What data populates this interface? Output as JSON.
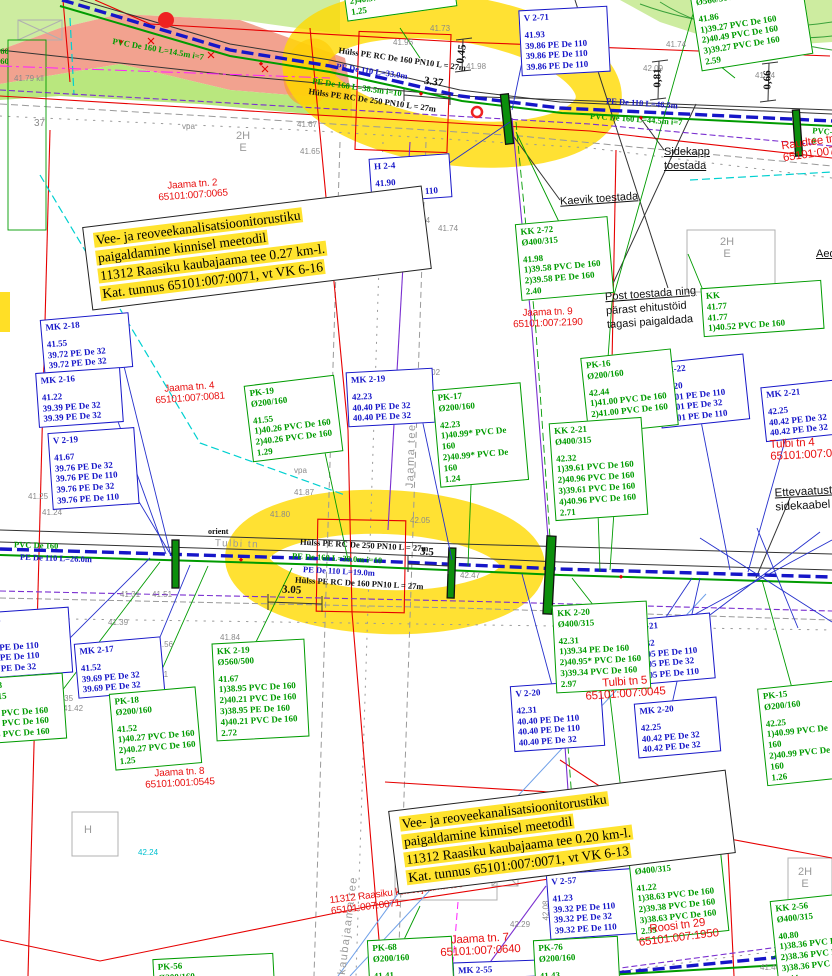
{
  "colors": {
    "water": "#1616c8",
    "sewer": "#009b00",
    "cadastral_red": "#e81111",
    "boundary_red": "#e60000",
    "highlight": "#ffd900",
    "cable_purple": "#7a2fd0",
    "magenta": "#ff00ff",
    "cyan": "#00d0d0",
    "survey_gray": "#8a8a8a"
  },
  "notes": {
    "note1": "Vee- ja reoveekanalisatsioonitorustiku\npaigaldamine kinnisel meetodil\n11312 Raasiku kaubajaama tee 0.27 km-l.\nKat. tunnus 65101:007:0071, vt VK 6-16",
    "note2": "Vee- ja reoveekanalisatsioonitorustiku\npaigaldamine kinnisel meetodil\n11312 Raasiku kaubajaama tee 0.20 km-l.\nKat. tunnus 65101:007:0071, vt VK 6-13"
  },
  "boxes": {
    "v2_71": {
      "t": "V 2-71",
      "b": "41.93\n39.86 PE De 110\n39.86 PE De 110\n39.86 PE De 110"
    },
    "h2_4": {
      "t": "H 2-4",
      "b": "41.90\n39.99 PE De 110"
    },
    "mk2_18": {
      "t": "MK 2-18",
      "b": "41.55\n39.72 PE De 32\n39.72 PE De 32"
    },
    "mk2_16": {
      "t": "MK 2-16",
      "b": "41.22\n39.39 PE De 32\n39.39 PE De 32"
    },
    "v2_19": {
      "t": "V 2-19",
      "b": "41.67\n39.76 PE De 32\n39.76 PE De 110\n39.76 PE De 32\n39.76 PE De 110"
    },
    "mk2_19": {
      "t": "MK 2-19",
      "b": "42.23\n40.40 PE De 32\n40.40 PE De 32"
    },
    "v2_22": {
      "t": "V 2-22",
      "b": "42.20\n40.01 PE De 110\n40.01 PE De 32\n40.01 PE De 110"
    },
    "mk2_21": {
      "t": "MK 2-21",
      "b": "42.25\n40.42 PE De 32\n40.42 PE De 32"
    },
    "v2_18": {
      "t": "V 2-18",
      "b": "41.08\n39.11 PE De 110\n39.11 PE De 110\n39.11 PE De 32"
    },
    "mk2_17": {
      "t": "MK 2-17",
      "b": "41.52\n39.69 PE De 32\n39.69 PE De 32"
    },
    "v2_21": {
      "t": "V 2-21",
      "b": "42.32\n40.05 PE De 110\n40.05 PE De 32\n40.05 PE De 110"
    },
    "v2_20": {
      "t": "V 2-20",
      "b": "42.31\n40.40 PE De 110\n40.40 PE De 110\n40.40 PE De 32"
    },
    "mk2_20": {
      "t": "MK 2-20",
      "b": "42.25\n40.42 PE De 32\n40.42 PE De 32"
    },
    "v2_57": {
      "t": "V 2-57",
      "b": "41.23\n39.32 PE De 110\n39.32 PE De 32\n39.32 PE De 110"
    },
    "mk2_55": {
      "t": "MK 2-55",
      "b": ""
    },
    "tl_part": {
      "t": "",
      "b": "2)40.37 PVC De 160\n1.25"
    },
    "o560": {
      "t": "Ø560/500",
      "b": "41.86\n1)39.27 PVC De 160\n2)40.49 PVC De 160\n3)39.27 PVC De 160\n2.59"
    },
    "kk2_72": {
      "t": "KK 2-72\nØ400/315",
      "b": "41.98\n1)39.58 PVC De 160\n2)39.58 PE De 160\n2.40"
    },
    "kk_part": {
      "t": "KK",
      "b": "41.77\n41.77\n1)40.52 PVC De 160"
    },
    "pk19": {
      "t": "PK-19\nØ200/160",
      "b": "41.55\n1)40.26 PVC De 160\n2)40.26 PVC De 160\n1.29"
    },
    "pk17": {
      "t": "PK-17\nØ200/160",
      "b": "42.23\n1)40.99* PVC De 160\n2)40.99* PVC De 160\n1.24"
    },
    "pk16": {
      "t": "PK-16\nØ200/160",
      "b": "42.44\n1)41.00 PVC De 160\n2)41.00 PVC De 160\n1.44"
    },
    "kk2_21": {
      "t": "KK 2-21\nØ400/315",
      "b": "42.32\n1)39.61 PVC De 160\n2)40.96 PVC De 160\n3)39.61 PVC De 160\n4)40.96 PVC De 160\n2.71"
    },
    "kk2_18": {
      "t": "KK 2-18\nØ400/315",
      "b": "1)38.76 PVC De 160\n2)38.71 PVC De 160\n3)38.76 PVC De 160"
    },
    "kk2_19": {
      "t": "KK 2-19\nØ560/500",
      "b": "41.67\n1)38.95 PVC De 160\n2)40.21 PVC De 160\n3)38.95 PE De 160\n4)40.21 PVC De 160\n2.72"
    },
    "pk18": {
      "t": "PK-18\nØ200/160",
      "b": "41.52\n1)40.27 PVC De 160\n2)40.27 PVC De 160\n1.25"
    },
    "kk2_20": {
      "t": "KK 2-20\nØ400/315",
      "b": "42.31\n1)39.34 PE De 160\n2)40.95* PVC De 160\n3)39.34 PVC De 160\n2.97"
    },
    "pk15": {
      "t": "PK-15\nØ200/160",
      "b": "42.25\n1)40.99 PVC De 160\n2)40.99 PVC De 160\n1.26"
    },
    "kk2_58": {
      "t": "KK 2-58\nØ400/315",
      "b": "41.22\n1)38.63 PVC De 160\n2)39.38 PVC De 160\n3)38.63 PVC De 160\n2.59"
    },
    "kk2_56": {
      "t": "KK 2-56\nØ400/315",
      "b": "40.80\n1)38.36 PVC De 160\n2)38.36 PVC De 160\n3)38.36 PVC De 160\n2.44"
    },
    "pk68": {
      "t": "PK-68\nØ200/160",
      "b": "41.41"
    },
    "pk76": {
      "t": "PK-76\nØ200/160",
      "b": "41.43"
    },
    "pk56": {
      "t": "PK-56\nØ200/160",
      "b": ""
    }
  },
  "cadastral": {
    "jaama2": "Jaama tn. 2\n65101:007:0065",
    "jaama4": "Jaama tn. 4\n65101:007:0081",
    "jaama9": "Jaama tn. 9\n65101:007:2190",
    "jaama8": "Jaama tn. 8\n65101:001:0545",
    "jaama7": "Jaama tn. 7\n65101:007:0640",
    "raudtee": "Raudtee tn\n65101:007:1",
    "tulbi4": "Tulbi tn 4\n65101:007:060",
    "tulbi5": "Tulbi tn 5\n65101:007:0045",
    "roosi29": "Roosi tn 29\n65101:007:1950",
    "kaubajaama": "11312 Raasiku kaubajaama tee\n65101:007:0071"
  },
  "annotations": {
    "kaevik": {
      "u": "Kaevik toestada",
      "rest": ""
    },
    "sidekapp": {
      "u": "Sidekapp\ntoestada",
      "rest": ""
    },
    "post": {
      "u": "Post toestada ning",
      "rest": "pärast ehitustöid\ntagasi paigaldada"
    },
    "ettevaatust": {
      "u": "Ettevaatust",
      "rest": "sidekaabel"
    },
    "aed": {
      "u": "Aed",
      "rest": ""
    }
  },
  "pipes": {
    "top_black": "Hülss PE RC De 160 PN10 L = 27m",
    "top_blue": "PE De 110 L=33.0m",
    "top_green": "PE De 160 L=38.5m i=10",
    "top_black2": "Hülss PE RC De 250 PN10 L = 27m",
    "tl_green": "PVC De 160 L=14.5m i=7",
    "tr_blue": "PE De 110 L=46.5m",
    "tr_green": "PVC De 160 L=44.5m i=7",
    "tr_green2": "PVC-6",
    "mid_black": "Hülss PE RC De 250 PN10 L = 27m",
    "mid_green": "PE De 160 L=39.0m i=10",
    "mid_blue": "PE De 110 L=19.0m",
    "mid_black2": "Hülss PE RC De 160 PN10 L = 27m",
    "ml_blue": "PE De 110 L=26.0m",
    "ml_green": "PVC De 160",
    "orient": "orient",
    "left160": "160\n160"
  },
  "dims": {
    "d337": "3.37",
    "d045": "0,45",
    "d081": "0,81",
    "d066": "0,66",
    "d35": "3.5",
    "d305": "3.05"
  },
  "streets": {
    "raasiku_kd": "Raasiku kd",
    "jaama_tee": "Jaama tee",
    "kaubajaama_tee": "kaubajaama tee",
    "tulbi_tn": "Tulbi tn"
  },
  "buildings": {
    "b2he": "2H\nE",
    "bh": "H"
  },
  "symbols": {
    "cable_marker": "⊕⊕",
    "vpa": "vpa",
    "parcel37": "37"
  },
  "elevations": [
    "41.79 kll",
    "37",
    "vpa",
    "41.73",
    "41.96",
    "41.85",
    "41.98",
    "41.62",
    "41.74",
    "42.09",
    "41.94",
    "41.67",
    "41.65",
    "41.94",
    "41.74",
    "42.02",
    "41.87",
    "41.80",
    "42.05",
    "vpa",
    "41.25",
    "41.24",
    "41.37",
    "41.51",
    "41.31",
    "41.39",
    "41.56",
    "41.61",
    "41.35",
    "41.42",
    "41.84",
    "42.47",
    "42.29",
    "41.40",
    "42.02",
    "42.08",
    "42.24"
  ]
}
